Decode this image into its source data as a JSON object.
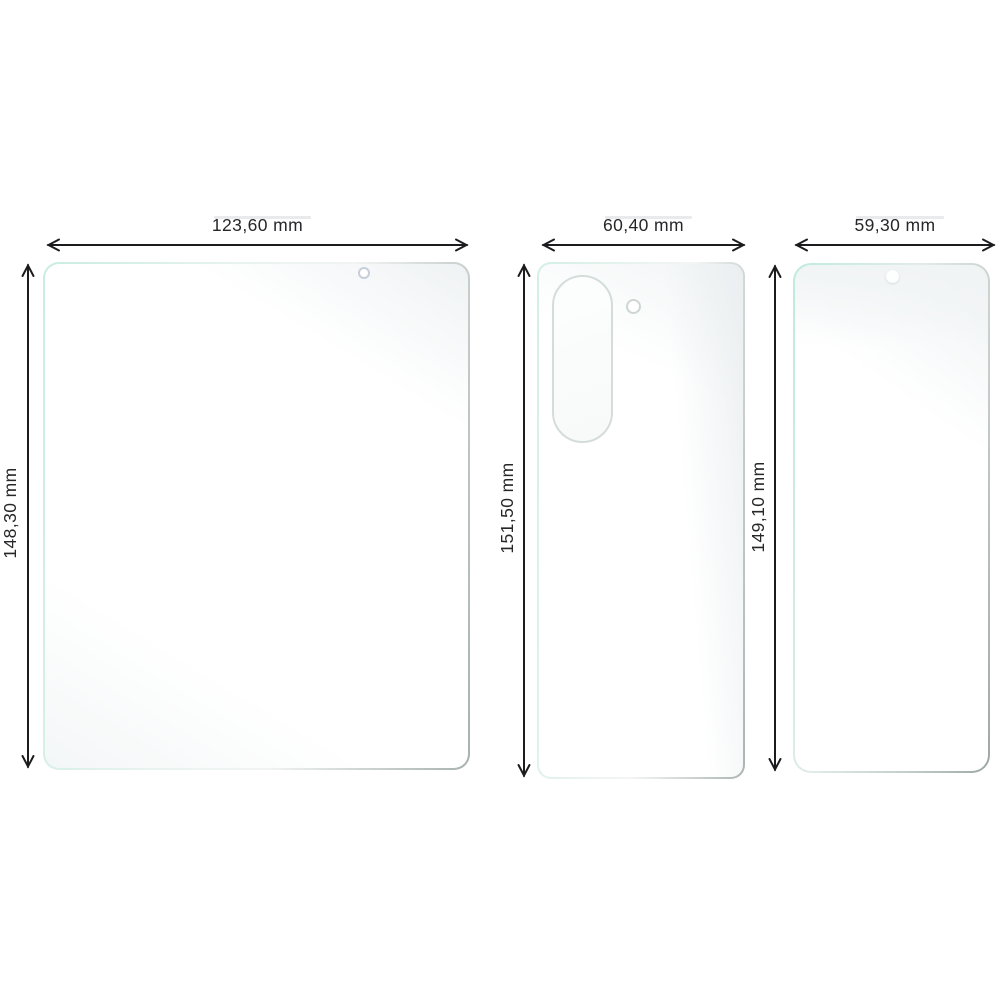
{
  "diagram": {
    "unit": "mm",
    "films": [
      {
        "shape": "inner-display-film",
        "width_label": "123,60 mm",
        "height_label": "148,30 mm"
      },
      {
        "shape": "back-panel-film",
        "width_label": "60,40 mm",
        "height_label": "151,50 mm"
      },
      {
        "shape": "cover-display-film",
        "width_label": "59,30 mm",
        "height_label": "149,10 mm"
      }
    ],
    "colors": {
      "background": "#ffffff",
      "arrow": "#1c1c1e",
      "film_border_mint": "#c9ede1",
      "film_border_gray": "#a7b2ae",
      "cutout_outline": "#d4ddd9",
      "hole_outline": "#c6ced9"
    }
  }
}
